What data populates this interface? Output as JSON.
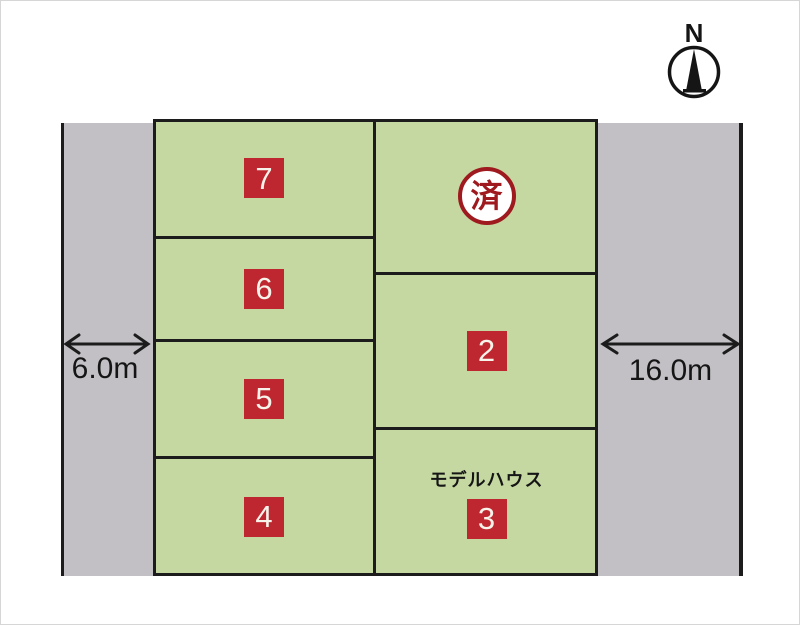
{
  "diagram_title": "land-plot-layout",
  "compass": {
    "north_label": "N"
  },
  "roads": {
    "left": {
      "width_label": "6.0m"
    },
    "right": {
      "width_label": "16.0m"
    }
  },
  "plots": {
    "p7": {
      "number": "7"
    },
    "p6": {
      "number": "6"
    },
    "p5": {
      "number": "5"
    },
    "p4": {
      "number": "4"
    },
    "sold": {
      "stamp_label": "済",
      "status": "sold"
    },
    "p2": {
      "number": "2"
    },
    "p3": {
      "number": "3",
      "note": "モデルハウス"
    }
  },
  "colors": {
    "plot_green": "#c5d8a2",
    "road_gray": "#c2c0c5",
    "badge_red": "#bf2730",
    "stamp_red": "#9e1a1e",
    "line_black": "#1c1c1c"
  }
}
